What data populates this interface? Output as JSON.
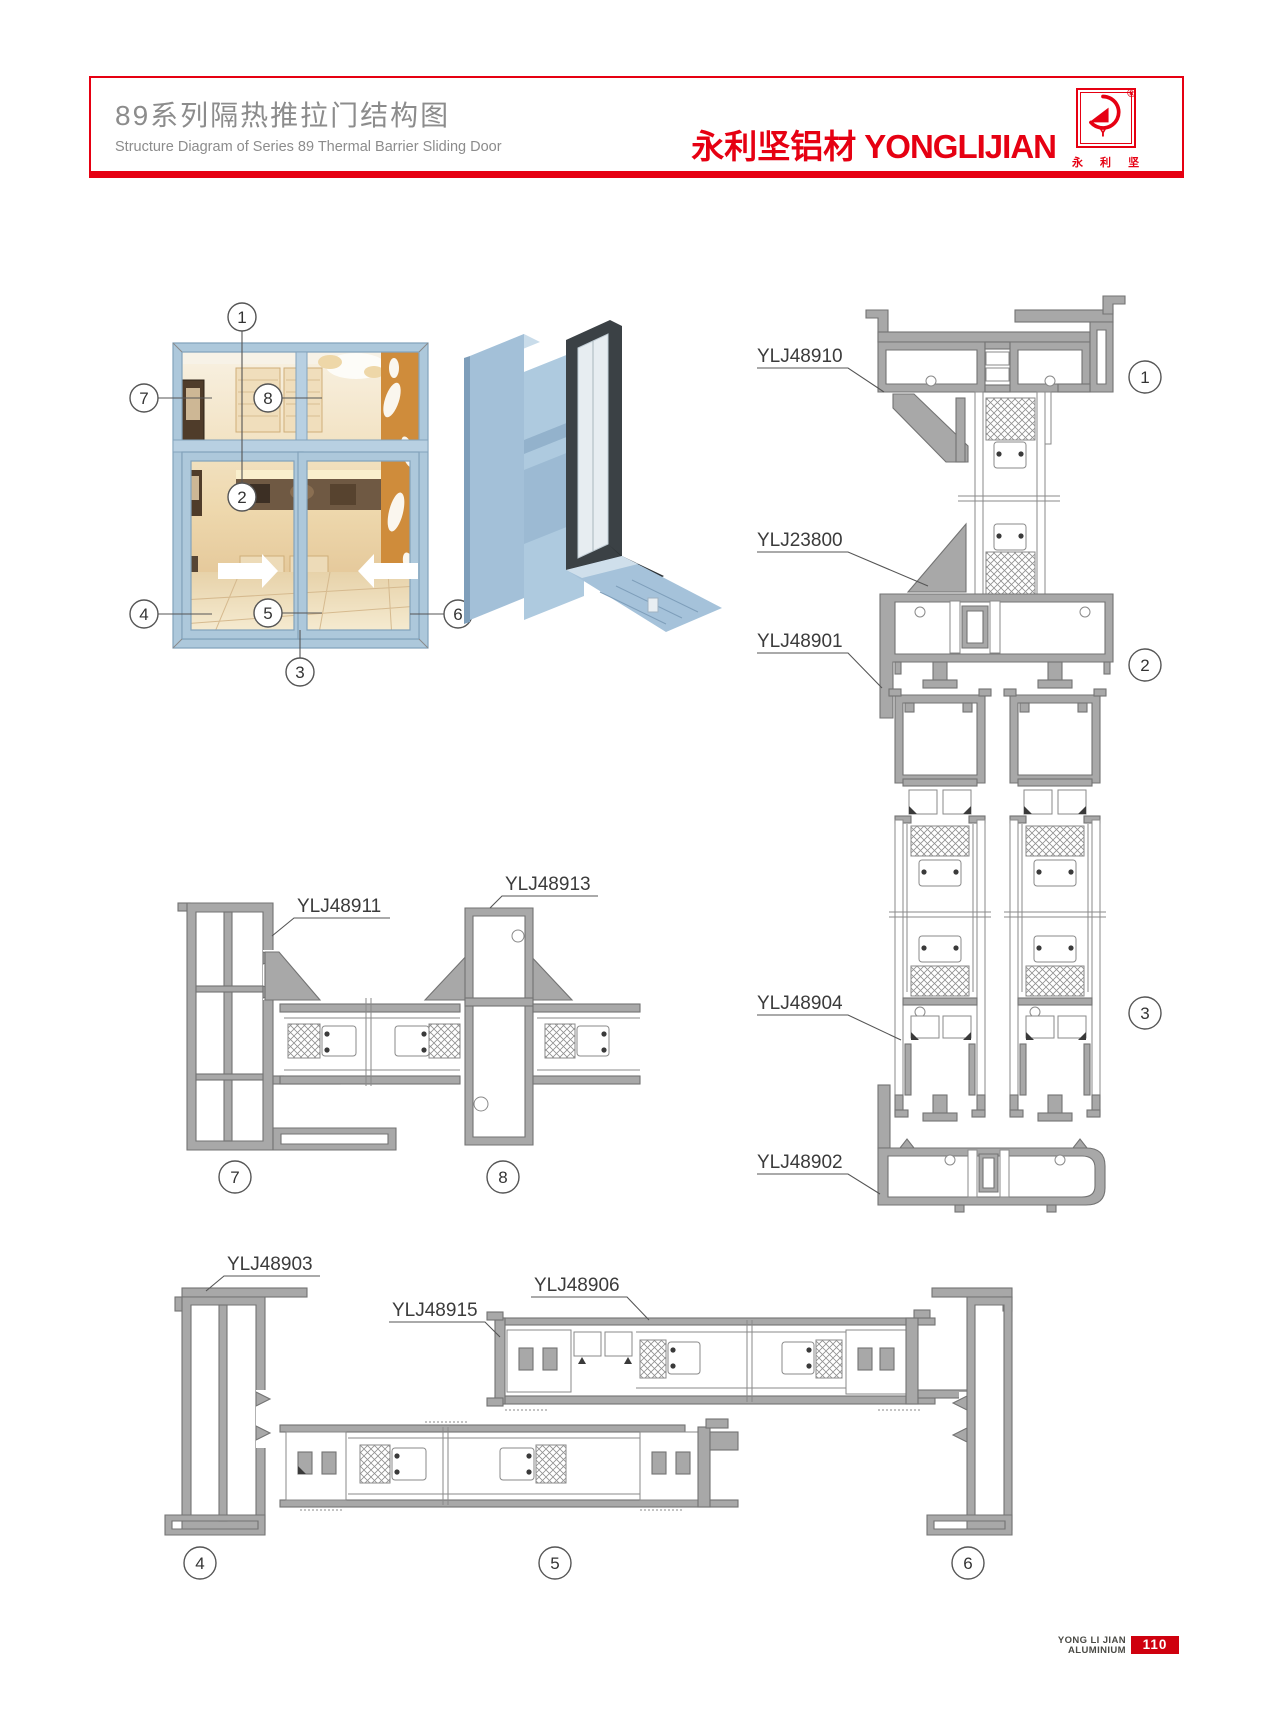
{
  "header": {
    "title_zh": "89系列隔热推拉门结构图",
    "title_en": "Structure Diagram of Series 89 Thermal Barrier Sliding Door",
    "brand_zh": "永利坚铝材",
    "brand_en": "YONGLIJIAN",
    "registered": "®",
    "logo_letter": "Y",
    "logo_caption": "永 利 坚"
  },
  "elevation": {
    "callouts": [
      "1",
      "2",
      "3",
      "4",
      "5",
      "6",
      "7",
      "8"
    ]
  },
  "sections": {
    "right": {
      "labels": [
        "YLJ48910",
        "YLJ23800",
        "YLJ48901",
        "YLJ48904",
        "YLJ48902"
      ],
      "callouts": [
        "1",
        "2",
        "3"
      ]
    },
    "middle": {
      "labels": [
        "YLJ48911",
        "YLJ48913"
      ],
      "callouts": [
        "7",
        "8"
      ]
    },
    "bottom": {
      "labels": [
        "YLJ48903",
        "YLJ48915",
        "YLJ48906"
      ],
      "callouts": [
        "4",
        "5",
        "6"
      ]
    }
  },
  "footer": {
    "brand_line1": "YONG LI JIAN",
    "brand_line2": "ALUMINIUM",
    "page_number": "110"
  },
  "colors": {
    "accent": "#e60012",
    "profile_gray": "#a8a8a8",
    "door_blue": "#a9c6dd"
  }
}
